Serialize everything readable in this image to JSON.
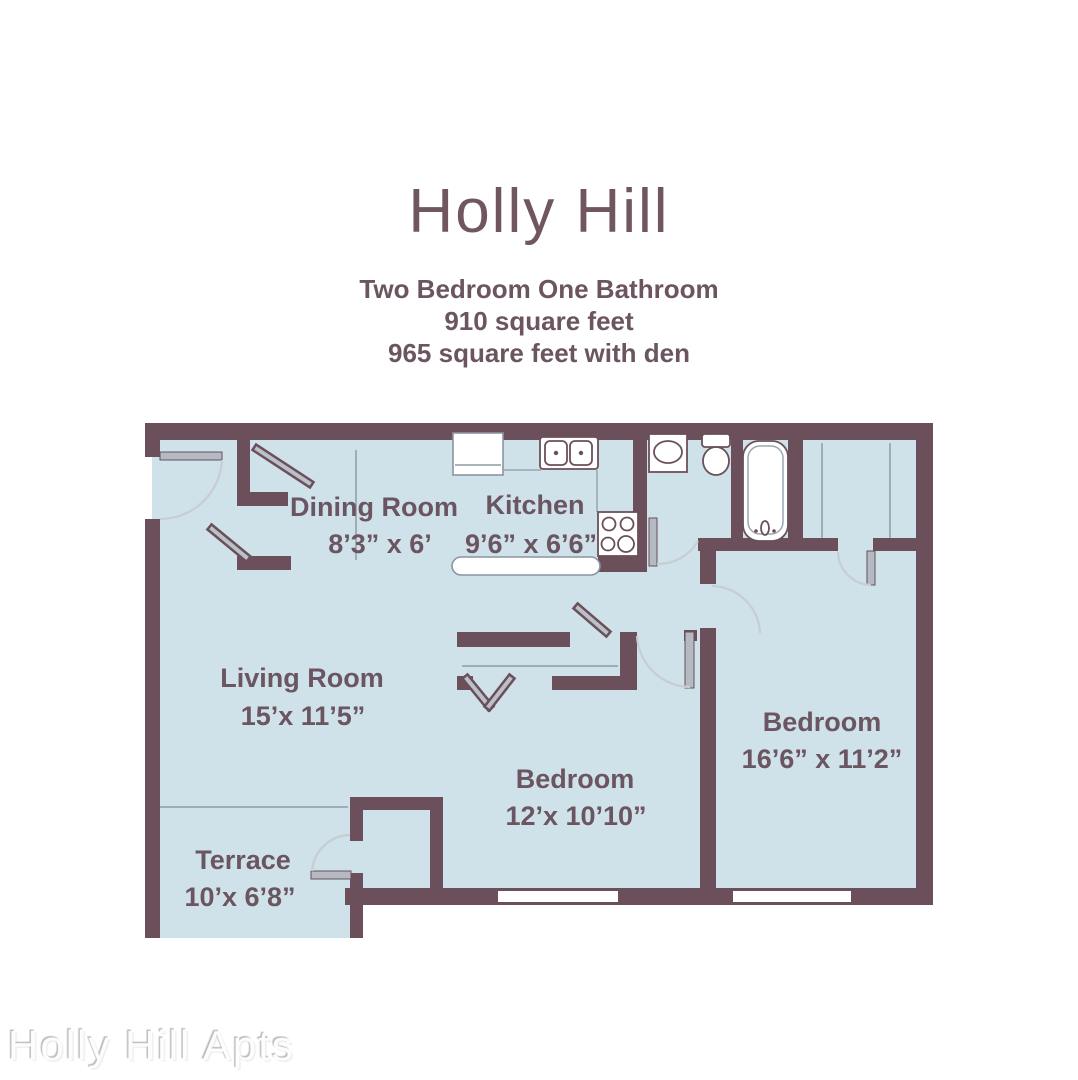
{
  "header": {
    "title": "Holly Hill",
    "subtitle_lines": [
      "Two Bedroom One Bathroom",
      "910 square feet",
      "965 square feet with den"
    ]
  },
  "floor_plan": {
    "rooms": [
      {
        "id": "dining_room",
        "name": "Dining Room",
        "dims": "8’3” x 6’"
      },
      {
        "id": "kitchen",
        "name": "Kitchen",
        "dims": "9’6” x 6’6”"
      },
      {
        "id": "living_room",
        "name": "Living Room",
        "dims": "15’x 11’5”"
      },
      {
        "id": "bedroom_middle",
        "name": "Bedroom",
        "dims": "12’x 10’10”"
      },
      {
        "id": "bedroom_right",
        "name": "Bedroom",
        "dims": "16’6” x 11’2”"
      },
      {
        "id": "terrace",
        "name": "Terrace",
        "dims": "10’x 6’8”"
      }
    ],
    "colors": {
      "wall": "#6b4f5a",
      "floor": "#cfe2ea",
      "label_text": "#6b5560",
      "door_arc": "#c7cdd3",
      "window": "#ffffff"
    }
  },
  "watermark": "Holly Hill Apts"
}
